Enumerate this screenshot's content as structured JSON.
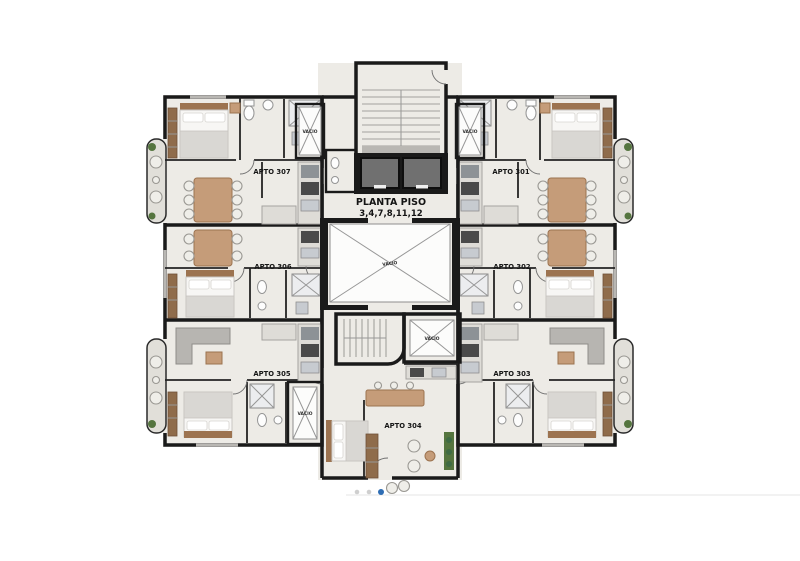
{
  "plan": {
    "title": {
      "line1": "PLANTA PISO",
      "line2": "3,4,7,8,11,12"
    },
    "apartments": [
      {
        "label": "APTO 307"
      },
      {
        "label": "APTO 301"
      },
      {
        "label": "APTO 306"
      },
      {
        "label": "APTO 302"
      },
      {
        "label": "APTO 305"
      },
      {
        "label": "APTO 303"
      },
      {
        "label": "APTO 304"
      }
    ],
    "voids": [
      {
        "label": "VACIO"
      },
      {
        "label": "VACIO"
      },
      {
        "label": "VACIO"
      },
      {
        "label": "VACIO"
      },
      {
        "label": "VACIO"
      }
    ],
    "colors": {
      "wall": "#1a1a1a",
      "floor": "#edebe6",
      "balcony_floor": "#e1dfd9",
      "elevator_cab": "#707070",
      "wood": "#c59c79",
      "wood_dark": "#9c7350",
      "fabric_gray": "#d9d7d3",
      "plant_green": "#55753f",
      "active_dot_blue": "#2e6db4",
      "inactive_dot_gray": "#cfcfcf"
    }
  },
  "pagination": {
    "dots": [
      {
        "state": "inactive"
      },
      {
        "state": "inactive"
      },
      {
        "state": "active"
      }
    ]
  }
}
